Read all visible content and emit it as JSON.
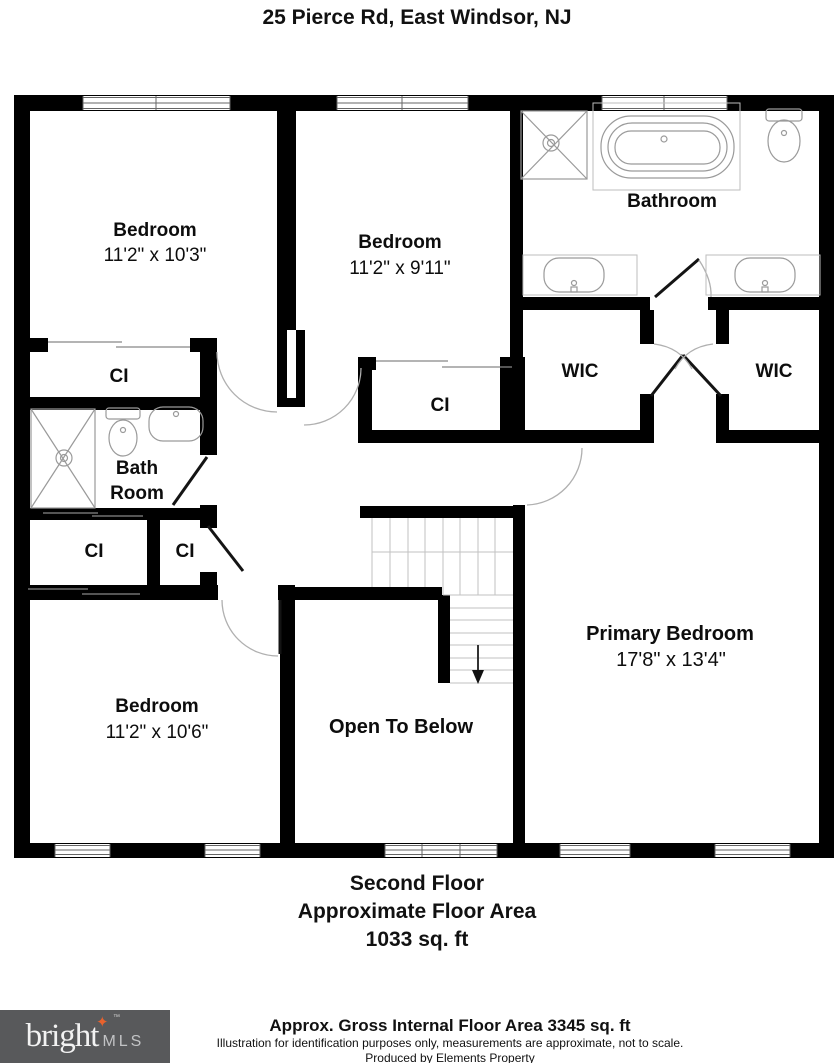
{
  "title": "25 Pierce Rd, East Windsor, NJ",
  "rooms": {
    "bedroom_top_left": {
      "name": "Bedroom",
      "dims": "11'2\" x 10'3\""
    },
    "bedroom_top_middle": {
      "name": "Bedroom",
      "dims": "11'2\" x 9'11\""
    },
    "bathroom": {
      "name": "Bathroom"
    },
    "wic_left": {
      "name": "WIC"
    },
    "wic_right": {
      "name": "WIC"
    },
    "closet_top_left": {
      "name": "CI"
    },
    "bath_room": {
      "line1": "Bath",
      "line2": "Room"
    },
    "closet_left_a": {
      "name": "CI"
    },
    "closet_left_b": {
      "name": "CI"
    },
    "closet_central": {
      "name": "CI"
    },
    "bedroom_bottom_left": {
      "name": "Bedroom",
      "dims": "11'2\" x 10'6\""
    },
    "open_to_below": {
      "name": "Open To Below"
    },
    "primary_bedroom": {
      "name": "Primary Bedroom",
      "dims": "17'8\" x 13'4\""
    }
  },
  "caption": {
    "line1": "Second Floor",
    "line2": "Approximate Floor Area",
    "line3": "1033 sq. ft"
  },
  "footer": {
    "area_note": "Approx. Gross Internal Floor Area 3345 sq. ft",
    "disclaimer": "Illustration for identification purposes only, measurements are approximate, not to scale.",
    "producer": "Produced by Elements Property",
    "logo_brand": "bright",
    "logo_suffix": "MLS",
    "logo_star": "✦",
    "logo_tm": "™"
  },
  "colors": {
    "wall": "#000000",
    "fixture_line": "#9a9a9a",
    "door_arc": "#b0b0b0",
    "logo_bg": "#58595b",
    "logo_star": "#e8622d",
    "logo_mls": "#c2c3c5"
  }
}
